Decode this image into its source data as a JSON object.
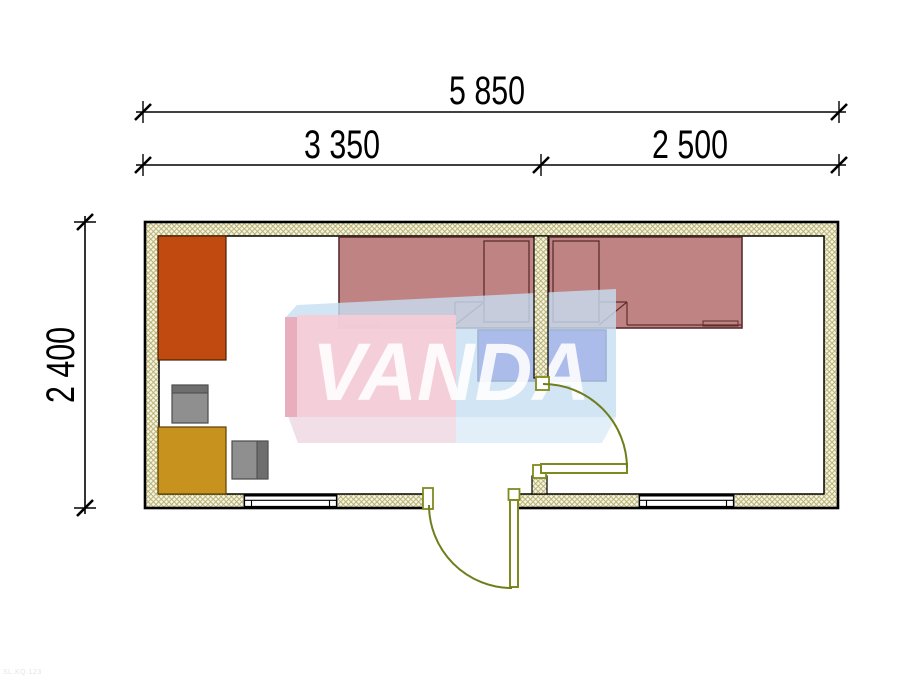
{
  "dimensions": {
    "overall_width": "5 850",
    "left_section": "3 350",
    "right_section": "2 500",
    "depth": "2 400"
  },
  "watermark": {
    "text": "VANDA"
  },
  "corner_code": "SL.KQ.123",
  "colors": {
    "bed": "#c08383",
    "bed_outline": "#5c2e2e",
    "nightstand": "#3c2fc9",
    "wardrobe": "#c04a10",
    "table": "#c8921e",
    "chair": "#8f8f8f",
    "chair_backrest": "#6e6e6e",
    "door": "#7f8a1e",
    "wall_fill": "#f6f3df",
    "wall_hatch": "#b2ac6c",
    "watermark_pink": "#f8ccd6",
    "watermark_pink_side": "#eda4b4",
    "watermark_pink_bottom": "#f6d8e0",
    "watermark_blue": "#c7dff2",
    "watermark_blue_bottom": "#cfe4f4",
    "dimension_color": "#000000"
  },
  "plan": {
    "type": "floor-plan",
    "rooms": [
      {
        "name": "left-room",
        "width_label": "3 350",
        "furniture": [
          "wardrobe",
          "chair",
          "table",
          "chair",
          "bed",
          "nightstand"
        ]
      },
      {
        "name": "right-room",
        "width_label": "2 500",
        "furniture": [
          "bed",
          "nightstand"
        ]
      }
    ],
    "openings": [
      "window-left",
      "entrance-door",
      "window-right",
      "interior-door"
    ]
  }
}
